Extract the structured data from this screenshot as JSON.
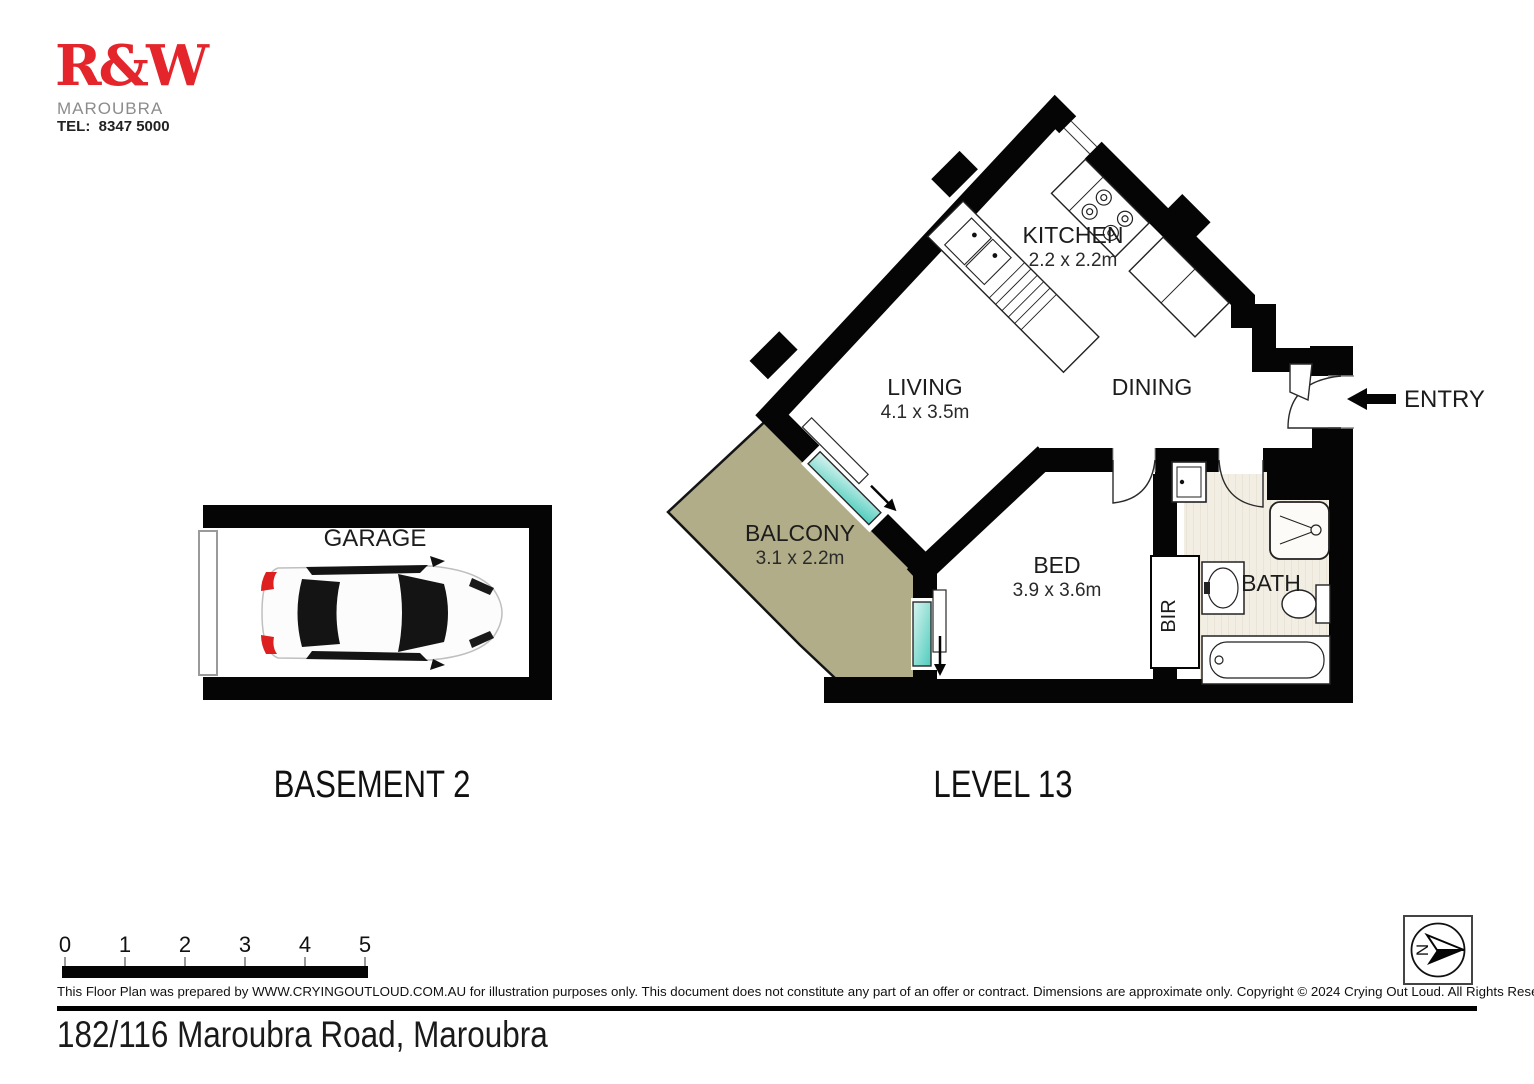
{
  "agency": {
    "logo": "R&W",
    "suburb": "MAROUBRA",
    "tel_label": "TEL:",
    "phone": "8347 5000"
  },
  "floorplans": {
    "basement": {
      "title": "BASEMENT 2",
      "garage_label": "GARAGE"
    },
    "level13": {
      "title": "LEVEL 13",
      "kitchen_label": "KITCHEN",
      "kitchen_dims": "2.2 x 2.2m",
      "living_label": "LIVING",
      "living_dims": "4.1 x 3.5m",
      "dining_label": "DINING",
      "balcony_label": "BALCONY",
      "balcony_dims": "3.1 x 2.2m",
      "bed_label": "BED",
      "bed_dims": "3.9 x 3.6m",
      "bath_label": "BATH",
      "bir_label": "BIR",
      "entry_label": "ENTRY"
    }
  },
  "scalebar": {
    "ticks": [
      "0",
      "1",
      "2",
      "3",
      "4",
      "5"
    ]
  },
  "compass": {
    "north": "N"
  },
  "footer": {
    "disclaimer": "This Floor Plan was prepared by WWW.CRYINGOUTLOUD.COM.AU for illustration purposes only. This document does not constitute any part of an offer or contract. Dimensions are approximate only. Copyright © 2024 Crying Out Loud. All Rights Reserved.",
    "address": "182/116 Maroubra Road, Maroubra"
  },
  "colors": {
    "wall": "#050505",
    "balcony_fill": "#b1ad89",
    "bath_floor": "#f2eee3",
    "glass": "#5ed2c4",
    "logo_red": "#e4262c"
  }
}
